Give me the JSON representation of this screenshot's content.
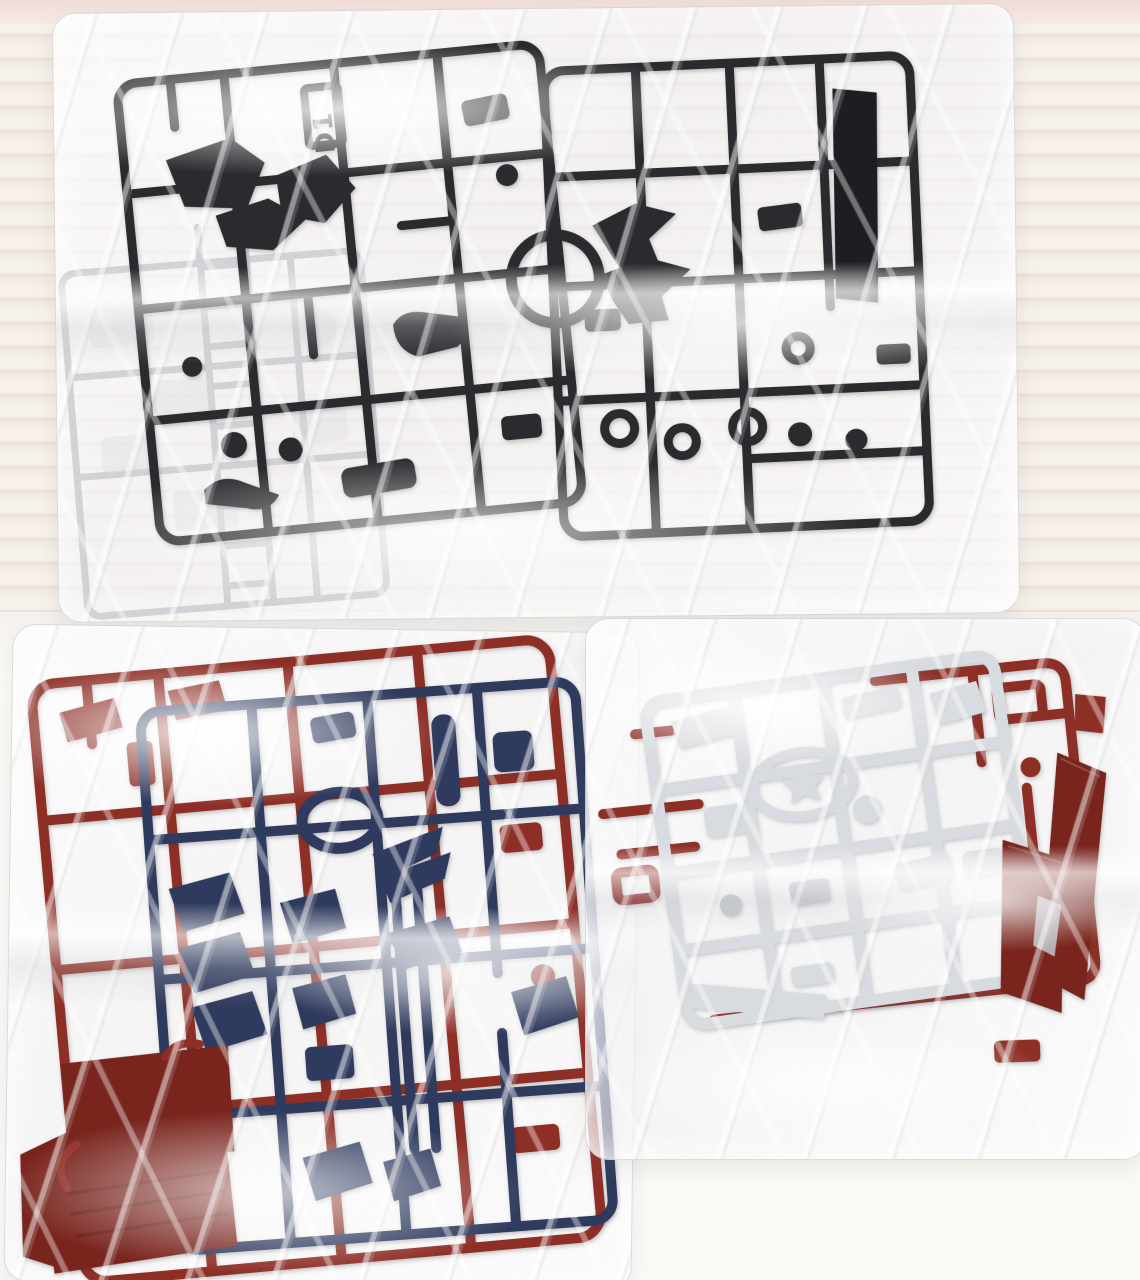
{
  "scene": {
    "sprue_tag": "D1"
  },
  "objects": {
    "top_bag": "clear plastic bag with two dark runner sprues and one clear runner sprue",
    "bottom_left_bag": "clear plastic bag with dark red runner sprue, navy blue runner sprue and flat dark red panels",
    "bottom_right_bag": "clear plastic bag with light gray runner sprue, dark red runner sprue and dark red blade panels"
  },
  "colors": {
    "dark_plastic": "#2a2b2e",
    "dark_plastic_deep": "#1d1e21",
    "red_plastic": "#8e2f26",
    "red_plastic_deep": "#79241d",
    "navy_plastic": "#2e3a5e",
    "white_plastic": "#d8dbdf",
    "white_plastic_shade": "#c3c7cd",
    "clear_plastic": "#cfcfd4",
    "clear_plastic_fill": "#d8d8dc",
    "background_stripe_light": "#f7f1ec",
    "background_stripe_dark": "#eae0da",
    "wall_top_band": "#f0dcd7",
    "floor_white": "#fbfaf7"
  }
}
